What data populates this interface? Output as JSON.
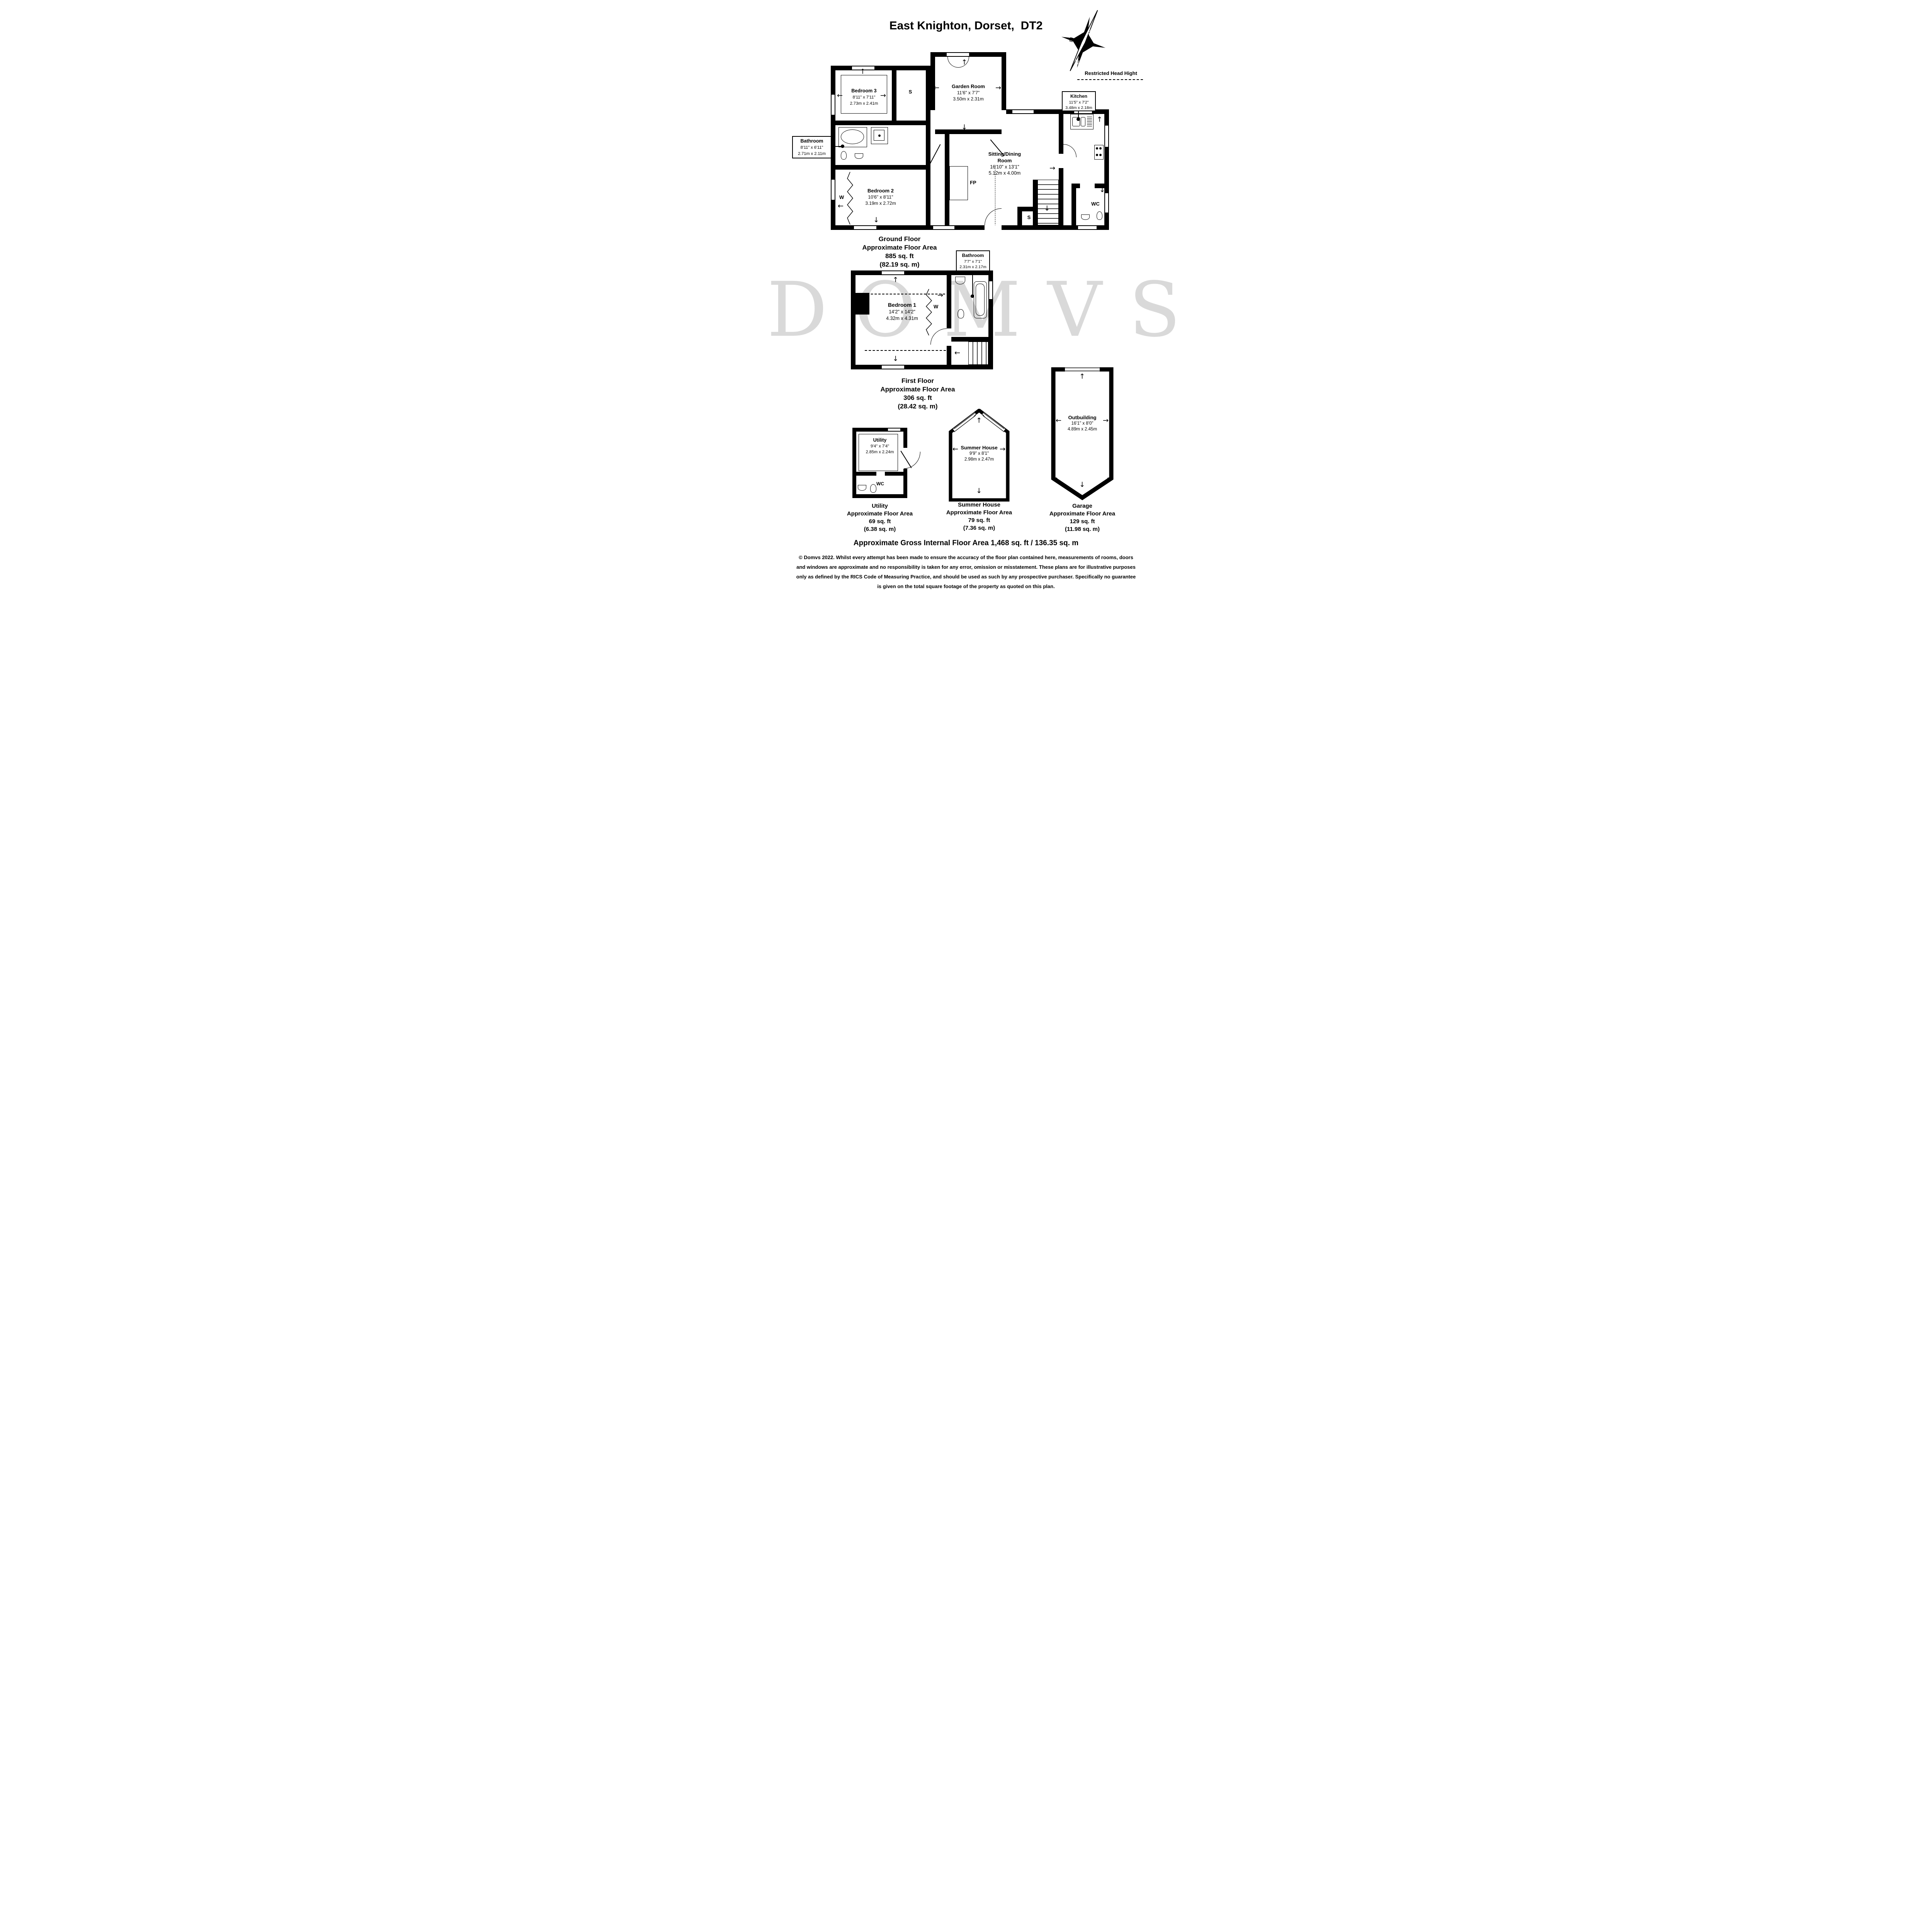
{
  "title": "East Knighton, Dorset,  DT2",
  "compass": {
    "n": "N",
    "s": "S",
    "e": "E",
    "w": "W"
  },
  "annotations": {
    "restricted_head_height": "Restricted Head Hight"
  },
  "watermark": "DOMVS",
  "ground_floor": {
    "caption": [
      "Ground Floor",
      "Approximate Floor Area",
      "885 sq. ft",
      "(82.19 sq. m)"
    ],
    "rooms": {
      "bedroom3": {
        "name": "Bedroom 3",
        "size_imperial": "8'11\" x 7'11\"",
        "size_metric": "2.73m x 2.41m"
      },
      "garden_room": {
        "name": "Garden Room",
        "size_imperial": "11'6\" x 7'7\"",
        "size_metric": "3.50m x 2.31m"
      },
      "kitchen": {
        "name": "Kitchen",
        "size_imperial": "11'5\" x 7'2\"",
        "size_metric": "3.48m x 2.18m"
      },
      "bathroom": {
        "name": "Bathroom",
        "size_imperial": "8'11\" x 6'11\"",
        "size_metric": "2.71m x 2.11m"
      },
      "bedroom2": {
        "name": "Bedroom 2",
        "size_imperial": "10'6\" x 8'11\"",
        "size_metric": "3.19m x 2.72m"
      },
      "sitting_dining": {
        "name_line1": "Sitting/Dining",
        "name_line2": "Room",
        "size_imperial": "16'10\" x 13'1\"",
        "size_metric": "5.12m x 4.00m"
      },
      "wc": {
        "name": "WC"
      }
    },
    "markers": {
      "storage1": "S",
      "storage2": "S",
      "fireplace": "FP",
      "wardrobe": "W"
    }
  },
  "first_floor": {
    "caption": [
      "First Floor",
      "Approximate Floor Area",
      "306 sq. ft",
      "(28.42 sq. m)"
    ],
    "rooms": {
      "bedroom1": {
        "name": "Bedroom 1",
        "size_imperial": "14'2\" x 14'2\"",
        "size_metric": "4.32m x 4.31m"
      },
      "bathroom": {
        "name": "Bathroom",
        "size_imperial": "7'7\" x 7'1\"",
        "size_metric": "2.31m x 2.17m"
      }
    },
    "markers": {
      "wardrobe": "W"
    }
  },
  "outbuildings": {
    "utility": {
      "room": {
        "name": "Utility",
        "size_imperial": "9'4\" x 7'4\"",
        "size_metric": "2.85m x 2.24m"
      },
      "wc_label": "WC",
      "caption": [
        "Utility",
        "Approximate Floor Area",
        "69 sq. ft",
        "(6.38 sq. m)"
      ]
    },
    "summer_house": {
      "room": {
        "name": "Summer House",
        "size_imperial": "9'9\" x 8'1\"",
        "size_metric": "2.98m x 2.47m"
      },
      "caption": [
        "Summer House",
        "Approximate Floor Area",
        "79 sq. ft",
        "(7.36 sq. m)"
      ]
    },
    "garage": {
      "room": {
        "name": "Outbuilding",
        "size_imperial": "16'1\" x 8'0\"",
        "size_metric": "4.89m x 2.45m"
      },
      "caption": [
        "Garage",
        "Approximate Floor Area",
        "129 sq. ft",
        "(11.98 sq. m)"
      ]
    }
  },
  "footer": {
    "gross_area": "Approximate Gross Internal Floor Area 1,468 sq. ft / 136.35 sq. m",
    "disclaimer": "© Domvs 2022. Whilst every attempt has been made to ensure the accuracy of the floor plan contained here, measurements of rooms, doors and windows are approximate and no responsibility is taken for any error, omission or misstatement. These plans are for illustrative purposes only as defined by the RICS Code of Measuring Practice, and should be used as such by any prospective purchaser. Specifically no guarantee is given on the total square footage of the property as quoted on this plan."
  }
}
